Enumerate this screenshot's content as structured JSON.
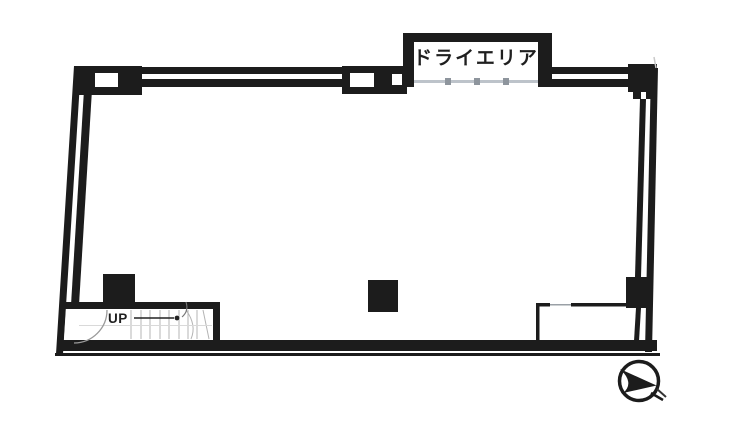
{
  "labels": {
    "dry_area": "ドライエリア",
    "stairs_up": "UP"
  },
  "colors": {
    "wall": "#1c1c1c",
    "paper": "#ffffff",
    "tread": "#b4b4b4",
    "glazing_line": "#bdc3ca",
    "glazing_mark": "#8e959d",
    "swing_arc": "#9a9a9a",
    "faint_line": "#d9d9d9",
    "partition_gap": "#9aa0a6",
    "arrow": "#222222"
  },
  "icons": {
    "north_arrow": "compass-dart-icon"
  }
}
